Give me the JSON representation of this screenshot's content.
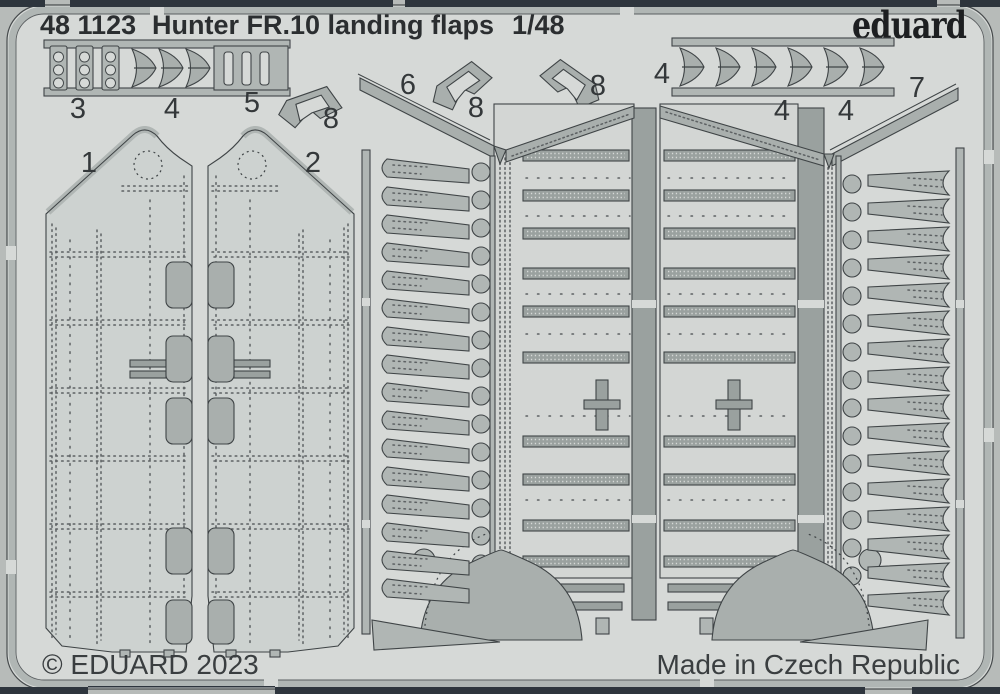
{
  "header": {
    "catalog": "48 1123",
    "title": "Hunter FR.10 landing flaps",
    "scale": "1/48",
    "brand": "eduard"
  },
  "footer": {
    "copyright": "© EDUARD 2023",
    "made_in": "Made in Czech Republic"
  },
  "sheet": {
    "kind": "photo-etched fret",
    "part_labels": [
      {
        "id": "flap-skin-panel-left",
        "num": "1"
      },
      {
        "id": "flap-skin-panel-right",
        "num": "2"
      },
      {
        "id": "hinge-strip-set",
        "num": "3"
      },
      {
        "id": "wing-bracket-set-left",
        "num": "4"
      },
      {
        "id": "slot-strip-set",
        "num": "5"
      },
      {
        "id": "bracket-lone",
        "num": "8"
      },
      {
        "id": "flap-structure-left",
        "num": "6"
      },
      {
        "id": "bracket-center-left",
        "num": "8"
      },
      {
        "id": "bracket-center-right",
        "num": "8"
      },
      {
        "id": "wing-strip-label-left",
        "num": "4"
      },
      {
        "id": "wing-strip-label-mid",
        "num": "4"
      },
      {
        "id": "wing-strip-label-right",
        "num": "4"
      },
      {
        "id": "flap-structure-right",
        "num": "7"
      }
    ]
  },
  "colors": {
    "mat": "#b7bbb9",
    "fret": "#d6d9d7",
    "part": "#b0b6b4",
    "part_mid": "#a9afad",
    "part_dark": "#9aa19f",
    "panel": "#cdd2d0",
    "body": "#d3d6d4",
    "outline": "#3f4446",
    "rivet": "#5d6163",
    "bar": "#2e353d",
    "text": "#2b2e30"
  }
}
